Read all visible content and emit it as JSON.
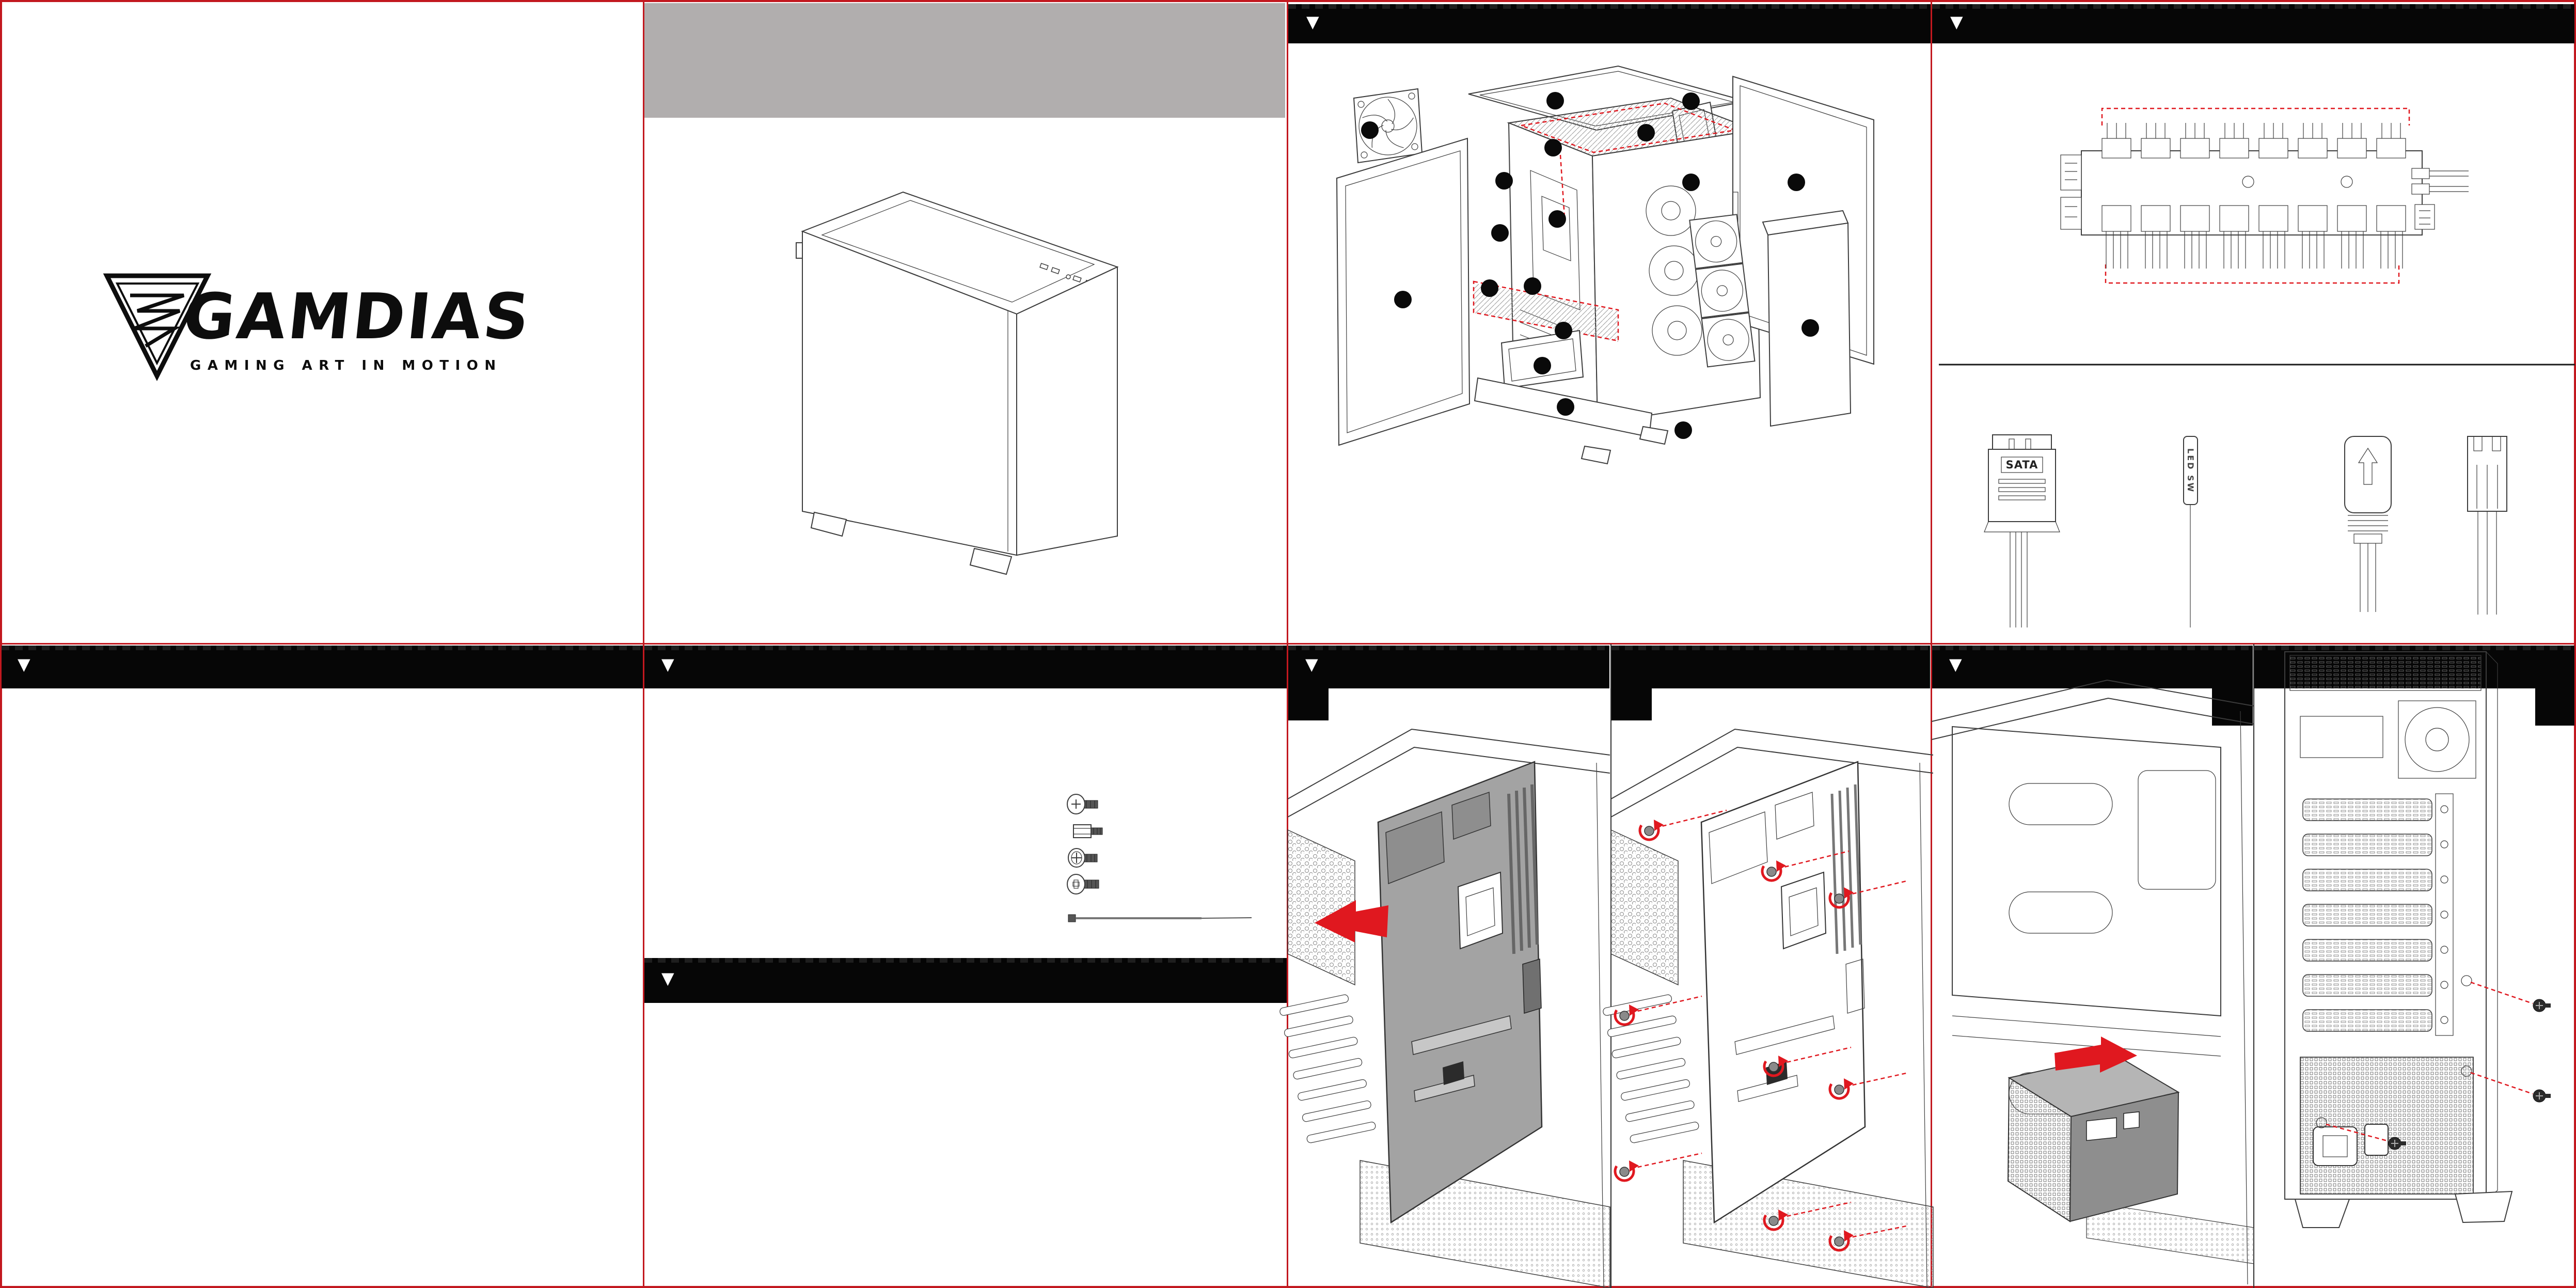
{
  "page": {
    "marker": "▼",
    "colors": {
      "sheet": "#ffffff",
      "grid_red": "#c2181f",
      "header_black": "#060606",
      "gray_band": "#b1aeae",
      "accent_red": "#e0181f",
      "line": "#3c3c3c"
    }
  },
  "brand": {
    "name": "GAMDIAS",
    "tagline": "GAMING ART IN MOTION"
  },
  "connectors": {
    "sata_label": "SATA",
    "led_sw_label": "LED SW",
    "argb_plug": "argb-arrow-plug",
    "fan_plug": "fan-3pin-plug"
  },
  "hub": {
    "top_header_count": 8,
    "bottom_header_count": 8
  },
  "exploded_view": {
    "callout_count": 18
  },
  "accessories": {
    "items": [
      "thumbscrew",
      "motherboard-standoff",
      "fan-screw",
      "phillips-screw",
      "cable-tie"
    ]
  },
  "steps": {
    "motherboard_screw_count": 9,
    "psu_screw_count": 3
  }
}
